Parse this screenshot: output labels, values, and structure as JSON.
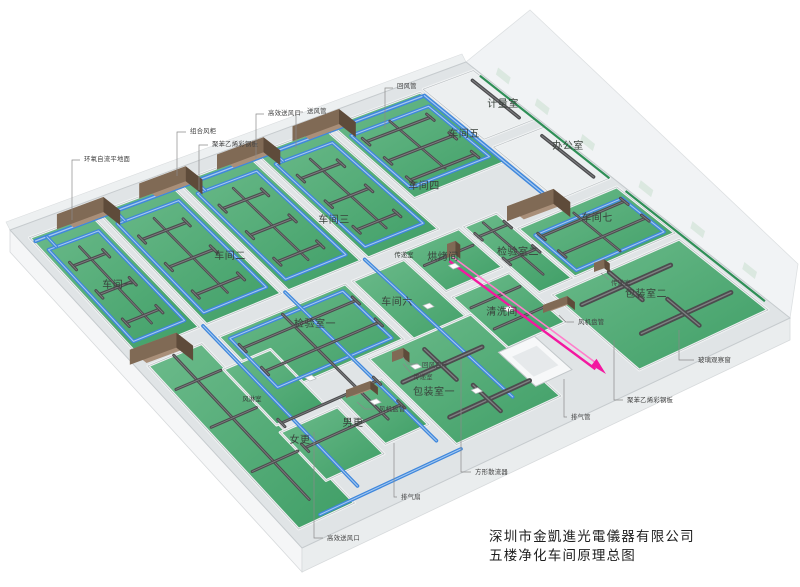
{
  "diagram": {
    "type": "isometric-cleanroom-hvac-overview",
    "floor_color": "#43a069",
    "supply_duct_color": "#3f87dc",
    "dark_duct_color": "#4c4c4e",
    "exhaust_duct_color": "#f318a0",
    "ahu_color": "#806a55"
  },
  "title": {
    "company": "深圳市金凱進光電儀器有限公司",
    "drawing": "五楼净化车间原理总图"
  },
  "labels": {
    "rooms": [
      {
        "t": "车间一",
        "x": 118,
        "y": 285
      },
      {
        "t": "车间二",
        "x": 230,
        "y": 256
      },
      {
        "t": "车间三",
        "x": 334,
        "y": 220
      },
      {
        "t": "车间四",
        "x": 424,
        "y": 186
      },
      {
        "t": "车间五",
        "x": 464,
        "y": 134
      },
      {
        "t": "计量室",
        "x": 503,
        "y": 104
      },
      {
        "t": "办公室",
        "x": 568,
        "y": 146
      },
      {
        "t": "车间七",
        "x": 597,
        "y": 218
      },
      {
        "t": "检验室二",
        "x": 518,
        "y": 252
      },
      {
        "t": "烘烤间",
        "x": 443,
        "y": 257
      },
      {
        "t": "清洗间",
        "x": 502,
        "y": 312
      },
      {
        "t": "车间六",
        "x": 397,
        "y": 302
      },
      {
        "t": "检验室一",
        "x": 315,
        "y": 324
      },
      {
        "t": "包装室一",
        "x": 434,
        "y": 392
      },
      {
        "t": "包装室二",
        "x": 646,
        "y": 294
      },
      {
        "t": "男更",
        "x": 353,
        "y": 423
      },
      {
        "t": "女更",
        "x": 300,
        "y": 440
      },
      {
        "t": "风淋室",
        "x": 252,
        "y": 398,
        "small": true
      },
      {
        "t": "传递室",
        "x": 404,
        "y": 254,
        "small": true
      }
    ],
    "callouts": [
      {
        "t": "环氧自流平地面",
        "x": 84,
        "y": 159,
        "leader": [
          [
            80,
            160
          ],
          [
            72,
            160
          ],
          [
            72,
            220
          ]
        ]
      },
      {
        "t": "组合风柜",
        "x": 190,
        "y": 131,
        "leader": [
          [
            186,
            132
          ],
          [
            177,
            132
          ],
          [
            177,
            176
          ]
        ]
      },
      {
        "t": "聚苯乙烯彩钢板",
        "x": 212,
        "y": 144,
        "leader": [
          [
            208,
            145
          ],
          [
            199,
            145
          ],
          [
            199,
            190
          ]
        ]
      },
      {
        "t": "高效送风口",
        "x": 268,
        "y": 113,
        "leader": [
          [
            264,
            114
          ],
          [
            256,
            114
          ],
          [
            256,
            158
          ]
        ]
      },
      {
        "t": "送风管",
        "x": 307,
        "y": 111,
        "leader": [
          [
            303,
            112
          ],
          [
            296,
            112
          ],
          [
            296,
            148
          ]
        ]
      },
      {
        "t": "回风管",
        "x": 397,
        "y": 86,
        "leader": [
          [
            393,
            88
          ],
          [
            385,
            88
          ],
          [
            385,
            128
          ]
        ]
      },
      {
        "t": "回风百叶",
        "x": 422,
        "y": 365,
        "leader": [
          [
            418,
            364
          ],
          [
            408,
            364
          ],
          [
            403,
            357
          ]
        ]
      },
      {
        "t": "传递室",
        "x": 413,
        "y": 377,
        "leader": [
          [
            411,
            373
          ],
          [
            403,
            364
          ]
        ]
      },
      {
        "t": "风机盘管",
        "x": 379,
        "y": 409,
        "leader": [
          [
            375,
            409
          ],
          [
            365,
            409
          ],
          [
            357,
            402
          ]
        ]
      },
      {
        "t": "传递室",
        "x": 611,
        "y": 283,
        "leader": [
          [
            609,
            280
          ],
          [
            601,
            273
          ]
        ]
      },
      {
        "t": "风机盘管",
        "x": 578,
        "y": 322,
        "leader": [
          [
            574,
            322
          ],
          [
            566,
            322
          ],
          [
            559,
            315
          ]
        ]
      },
      {
        "t": "玻璃观察窗",
        "x": 698,
        "y": 360,
        "leader": [
          [
            694,
            360
          ],
          [
            679,
            360
          ],
          [
            679,
            330
          ]
        ]
      },
      {
        "t": "聚苯乙烯彩钢板",
        "x": 627,
        "y": 400,
        "leader": [
          [
            623,
            400
          ],
          [
            614,
            400
          ],
          [
            614,
            340
          ]
        ]
      },
      {
        "t": "排气管",
        "x": 571,
        "y": 417,
        "leader": [
          [
            567,
            417
          ],
          [
            564,
            417
          ],
          [
            564,
            379
          ]
        ]
      },
      {
        "t": "排气扇",
        "x": 401,
        "y": 497,
        "leader": [
          [
            397,
            497
          ],
          [
            394,
            497
          ],
          [
            394,
            443
          ]
        ]
      },
      {
        "t": "方形散流器",
        "x": 475,
        "y": 472,
        "leader": [
          [
            471,
            472
          ],
          [
            461,
            472
          ],
          [
            461,
            360
          ]
        ]
      },
      {
        "t": "高效送风口",
        "x": 327,
        "y": 538,
        "leader": [
          [
            323,
            538
          ],
          [
            314,
            538
          ],
          [
            314,
            432
          ]
        ]
      }
    ]
  }
}
